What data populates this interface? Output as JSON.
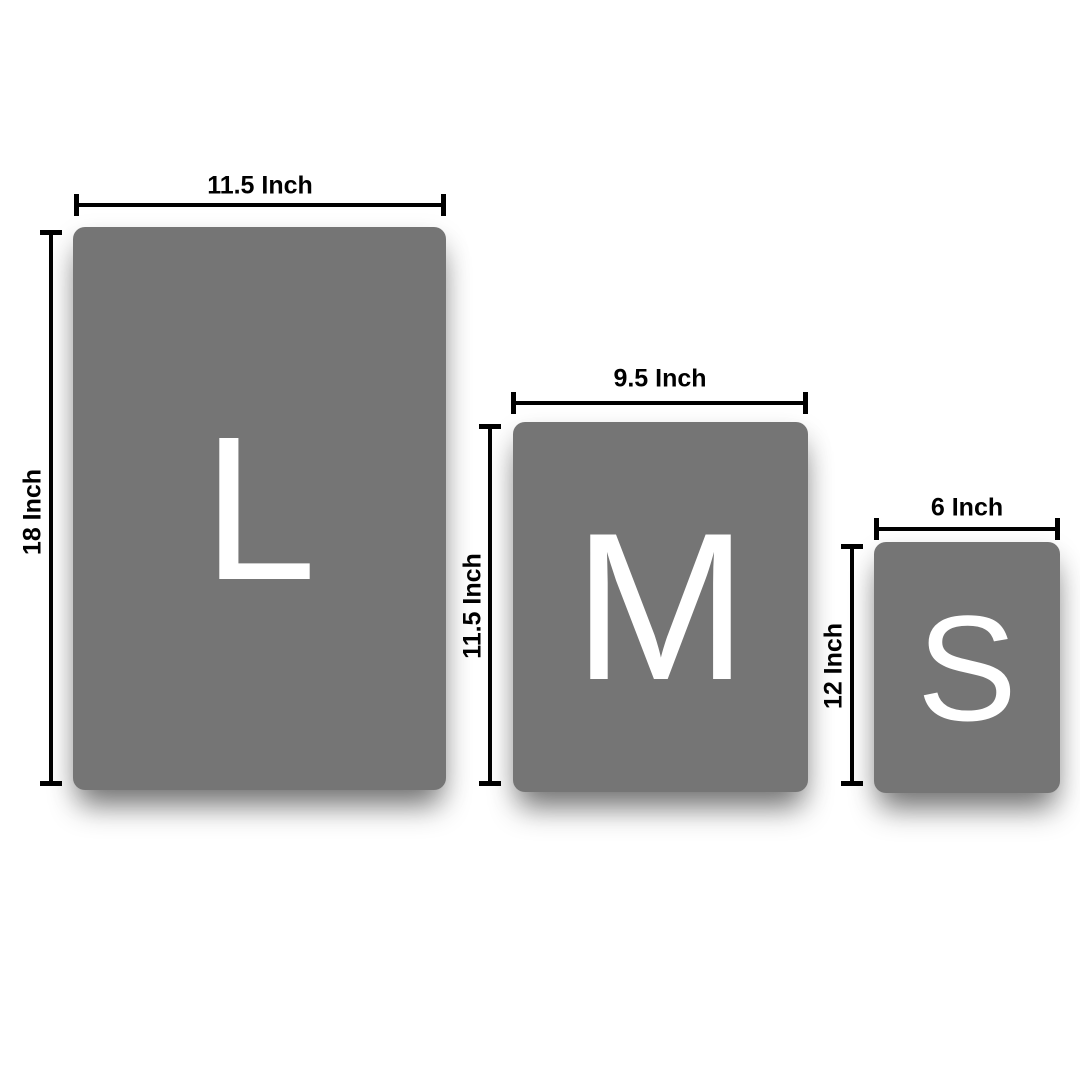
{
  "diagram": {
    "kind": "product-size-comparison",
    "unit": "Inch"
  },
  "colors": {
    "panel_gray": "#757575",
    "measure_black": "#000000",
    "letter_white": "#ffffff",
    "background_white": "#ffffff"
  },
  "panels": [
    {
      "id": "large",
      "letter": "L",
      "width_label": "11.5 Inch",
      "height_label": "18 Inch"
    },
    {
      "id": "medium",
      "letter": "M",
      "width_label": "9.5 Inch",
      "height_label": "11.5 Inch"
    },
    {
      "id": "small",
      "letter": "S",
      "width_label": "6 Inch",
      "height_label": "12 Inch"
    }
  ]
}
